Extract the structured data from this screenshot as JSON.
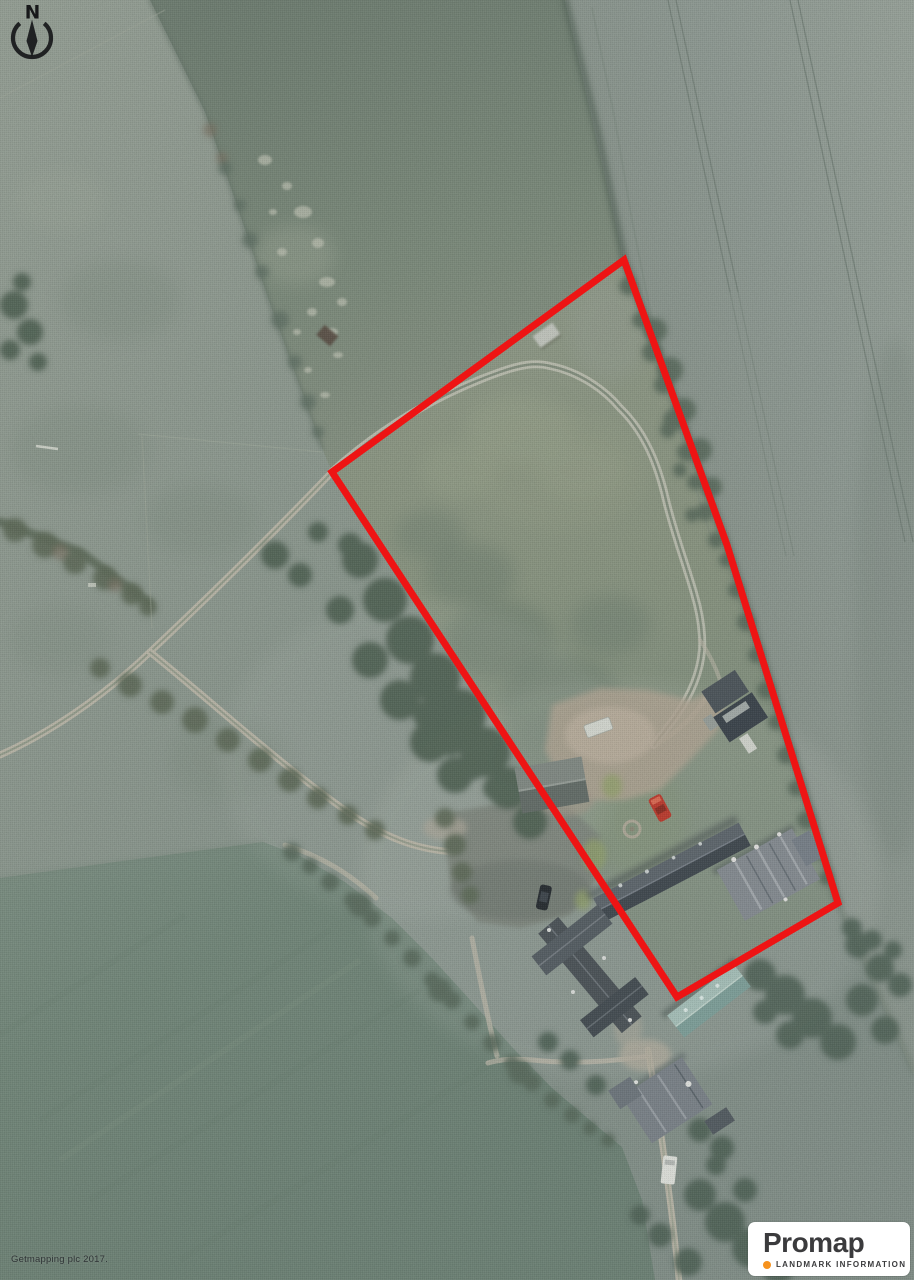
{
  "map": {
    "compass": {
      "label": "N"
    },
    "credit": {
      "text": "Getmapping plc 2017."
    },
    "boundary": {
      "color": "#ee1414",
      "stroke_width": 7,
      "points": "624,260 727,545 838,903 677,997 332,472"
    },
    "logo": {
      "brand": "Promap",
      "subtitle": "LANDMARK INFORMATION",
      "dot_color": "#f6921e",
      "text_color": "#3b3b3d",
      "background": "#ffffff"
    },
    "imagery": {
      "kind": "aerial-photograph",
      "palette": {
        "pasture": "#8d9a90",
        "crop_field": "#909c95",
        "dark_field": "#76867a",
        "bottom_field": "#70867a",
        "track": "#bcb9aa",
        "farmyard": "#b3a795",
        "trees": "#4d6053",
        "barn_roof_teal": "#8fb0aa",
        "slate_roof": "#49525a"
      }
    }
  }
}
